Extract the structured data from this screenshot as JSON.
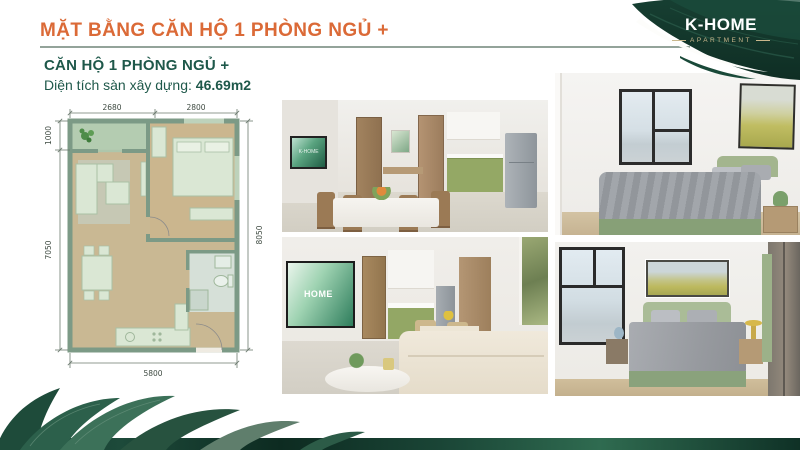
{
  "header": {
    "title": "MẶT BẰNG CĂN HỘ 1 PHÒNG NGỦ +"
  },
  "logo": {
    "name": "K-HOME",
    "subtitle": "APARTMENT"
  },
  "unit_info": {
    "name": "CĂN HỘ 1 PHÒNG NGỦ +",
    "area_label": "Diện tích sàn xây dựng:",
    "area_value": "46.69m2"
  },
  "floor_plan": {
    "dim_top_left": "2680",
    "dim_top_right": "2800",
    "dim_left_top": "1000",
    "dim_left_bottom": "7050",
    "dim_right": "8050",
    "dim_bottom": "5800"
  },
  "photos": [
    {
      "name": "dining-kitchen",
      "tv_text": "K-HOME"
    },
    {
      "name": "bedroom-window"
    },
    {
      "name": "living-room",
      "tv_text": "HOME"
    },
    {
      "name": "bedroom-master"
    }
  ],
  "colors": {
    "accent_orange": "#DB6A37",
    "text_green": "#1E584A",
    "brand_green_dark": "#143A2E",
    "logo_gold": "#C9B78C",
    "plan_wall": "#7C9A86",
    "plan_floor": "#C9B893",
    "plan_furniture": "#DAE7D4",
    "kitchen_green": "#94A865"
  }
}
